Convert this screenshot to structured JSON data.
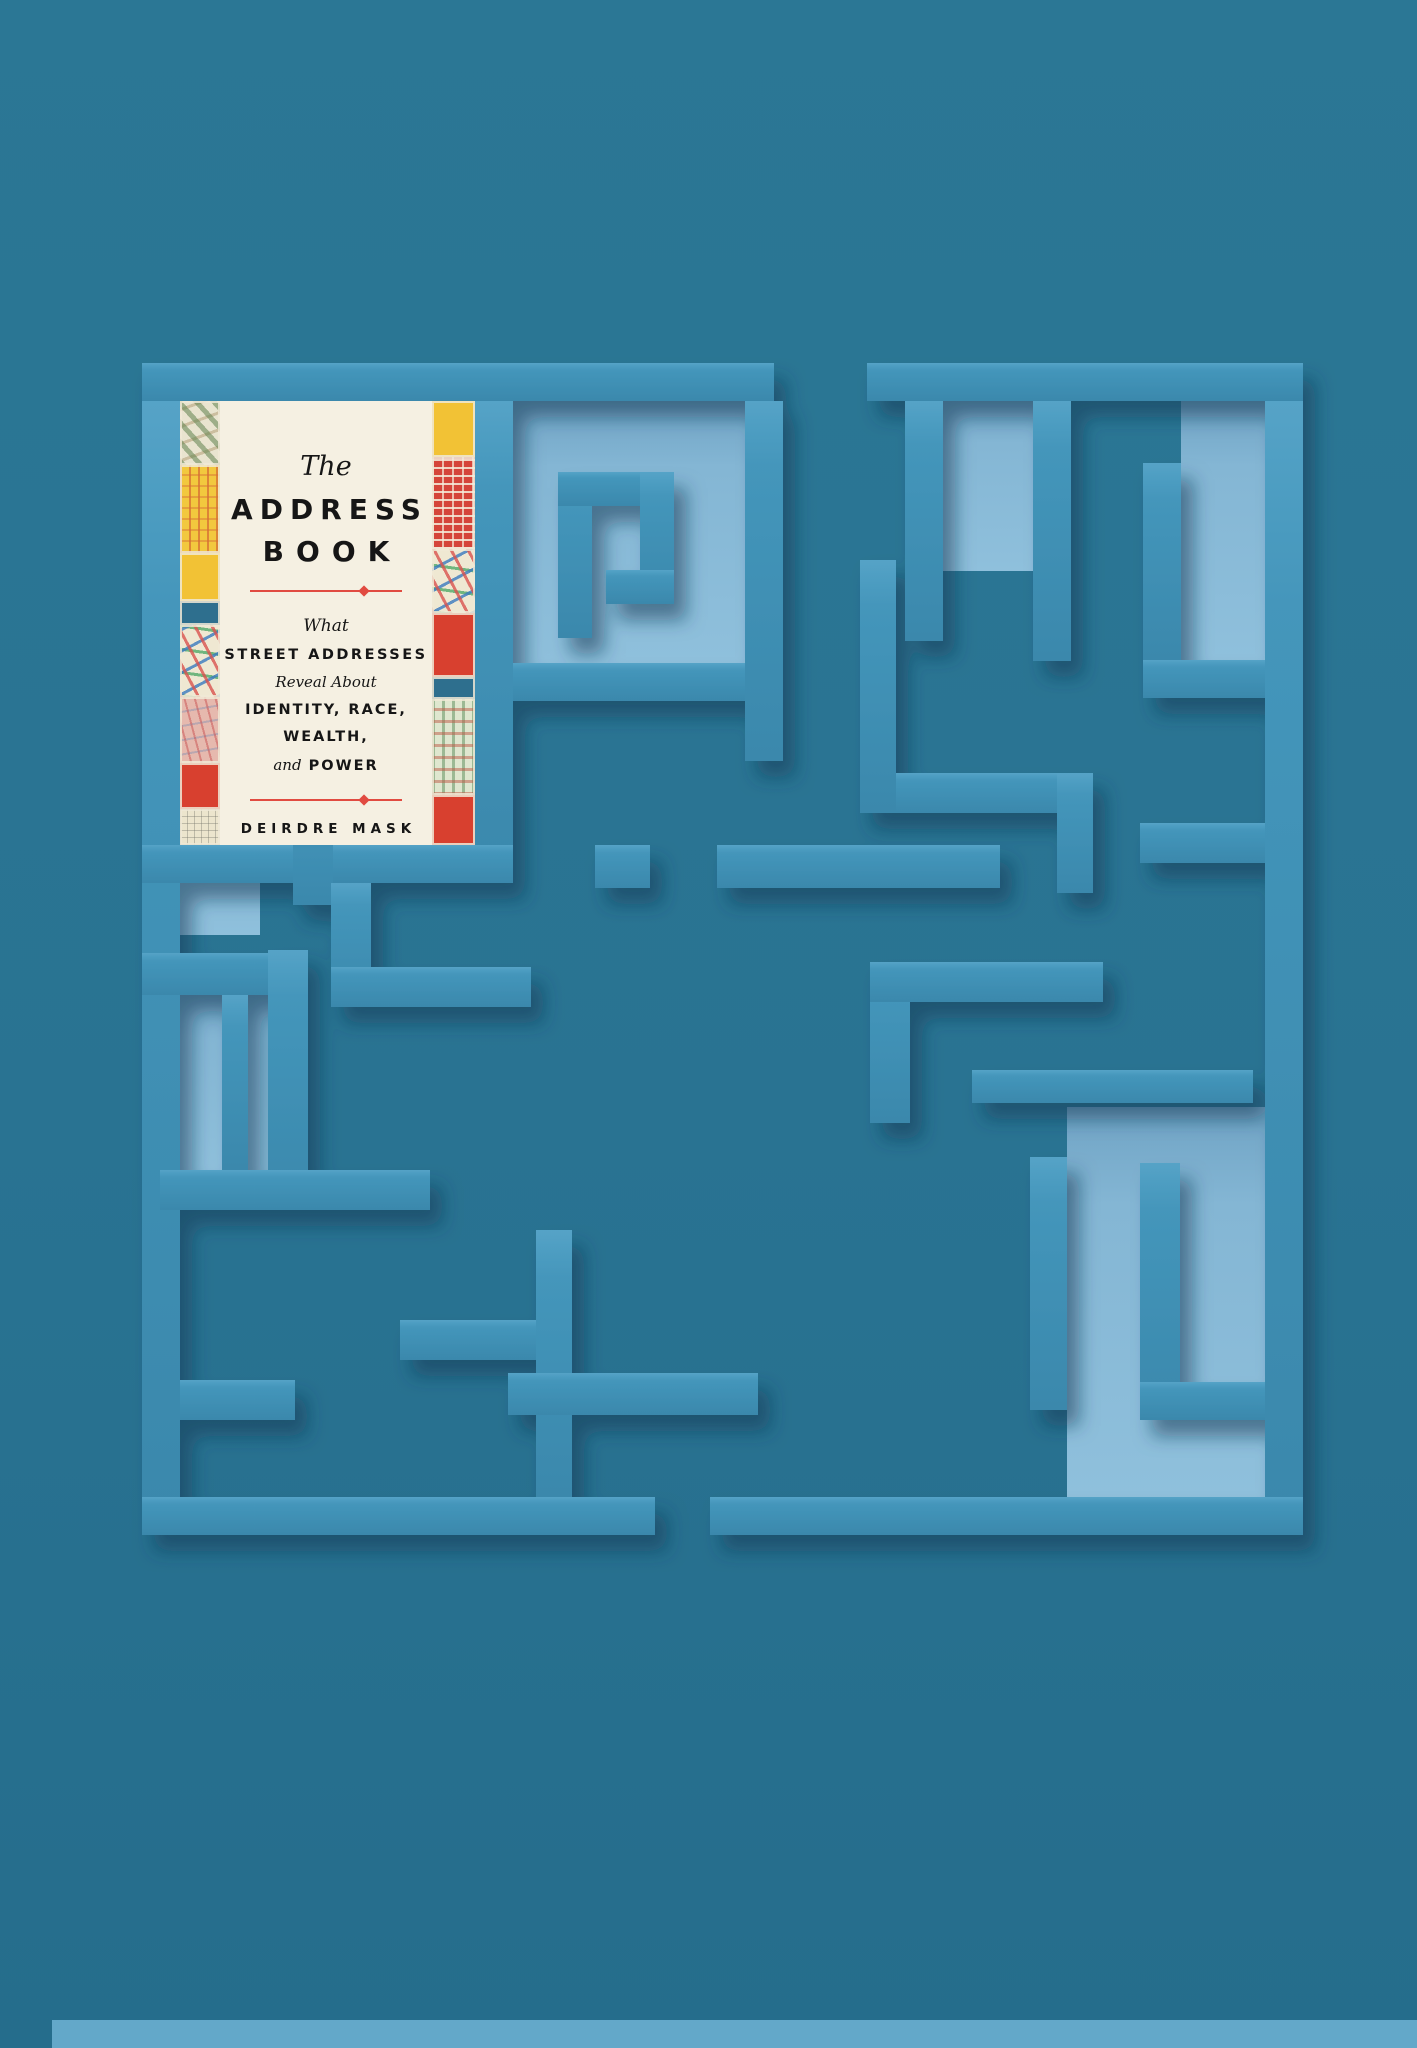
{
  "artwork": {
    "description": "Book 'The Address Book' set into the corner of a teal 3D maze",
    "background_color": "#2A7694",
    "bottom_band_color": "#63A8C9"
  },
  "maze": {
    "wall_color": "#4093B8",
    "wall_highlight_color": "#55A3C7",
    "recess_color": "#86B8D6",
    "shadow_color": "#0B3B55",
    "entrance": "top gap",
    "exit": "bottom gap"
  },
  "book_cover": {
    "title_prefix": "The",
    "title_line1": "ADDRESS",
    "title_line2": "BOOK",
    "subtitle_what": "What",
    "subtitle_street": "STREET ADDRESSES",
    "subtitle_reveal": "Reveal About",
    "subtitle_identity": "IDENTITY, RACE,",
    "subtitle_wealth": "WEALTH,",
    "subtitle_and": "and",
    "subtitle_power": "POWER",
    "author": "DEIRDRE MASK",
    "accent_color": "#E14B41",
    "paper_color": "#F5F0E2",
    "text_color": "#161616"
  }
}
